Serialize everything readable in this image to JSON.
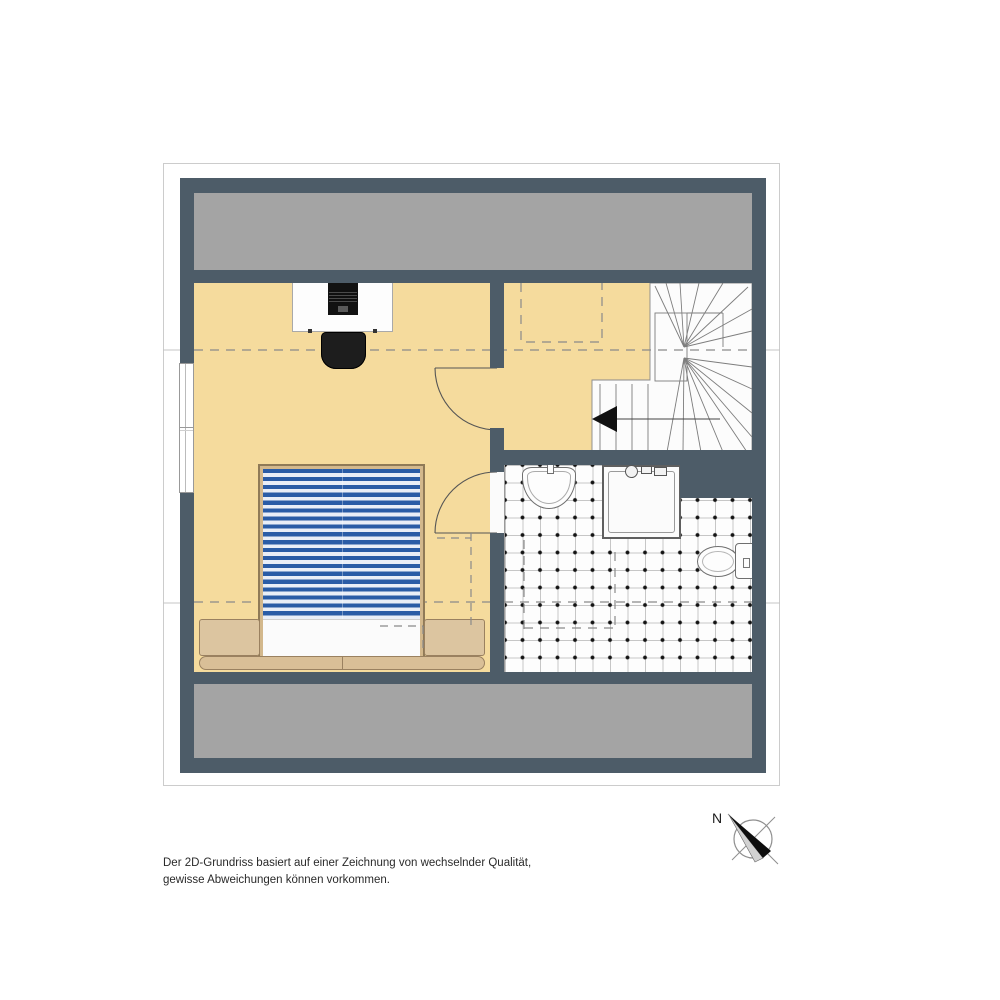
{
  "disclaimer": {
    "line1": "Der 2D-Grundriss basiert auf einer Zeichnung von wechselnder Qualität,",
    "line2": "gewisse Abweichungen können vorkommen."
  },
  "compass": {
    "label": "N"
  },
  "colors": {
    "wall": "#4d5c68",
    "floor": "#f5db9d",
    "band": "#a4a4a4",
    "stair": "#fcfcfc",
    "duvet": "#2a5ca6",
    "wood": "#d3b88c",
    "woodlight": "#dcc5a0",
    "dash": "#8a8a8a",
    "tiledot": "#141414"
  }
}
